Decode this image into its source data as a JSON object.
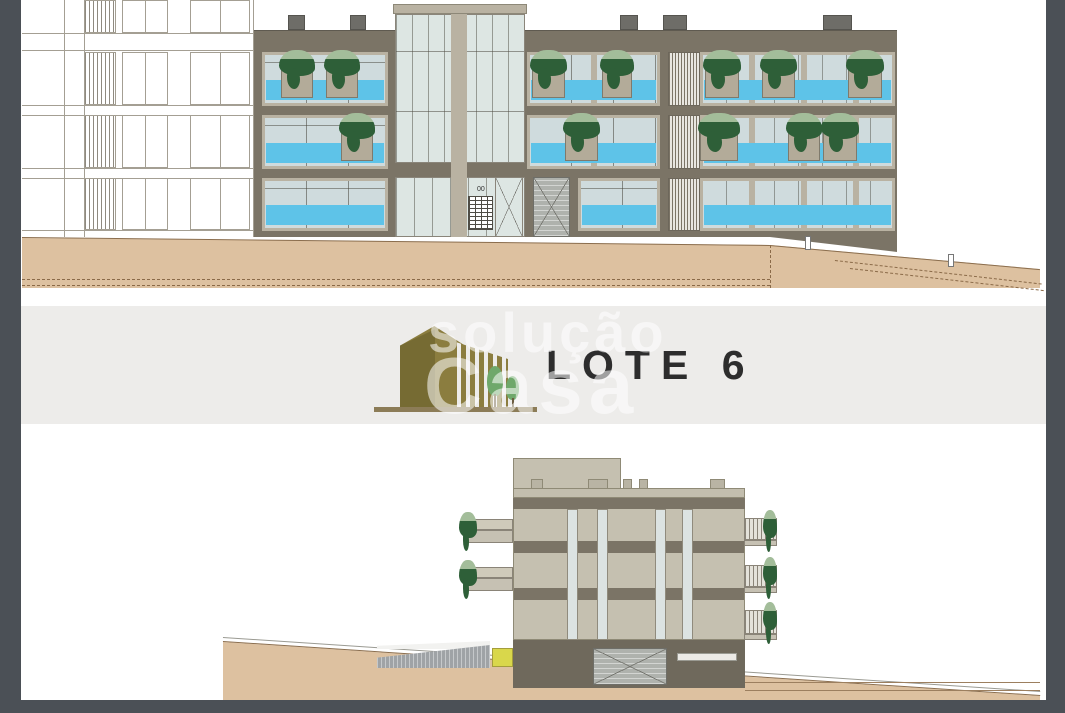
{
  "document": {
    "type": "architectural-elevation-sheet",
    "lot_label": "LOTE 6",
    "stair_level_label": "00",
    "watermark": {
      "word1": "solução",
      "word2": "Casa"
    }
  },
  "palette": {
    "chrome": "#4b5056",
    "page": "#ffffff",
    "band_bg": "#edecea",
    "facade_dark": "#7b7466",
    "frame_beige": "#b9b2a2",
    "glass": "#cfdbdd",
    "glass_pale": "#dde6e3",
    "spandrel": "#5ec3e8",
    "planter": "#b3ab99",
    "plant": "#2e5f38",
    "terrain": "#ddc1a0",
    "terrain_line": "#8b6e4e",
    "side_beige": "#c5c0b0",
    "base_dark": "#6f695c",
    "door_grey": "#afb2ad",
    "ramp_grey": "#9fa3a6",
    "accent_yellow": "#d9d74b",
    "logo_olive": "#8b7d3f",
    "logo_olive_dark": "#766b33",
    "tree_green": "#6fa86b",
    "baseline_brown": "#8c7c57",
    "title_text": "#2d2d2d"
  }
}
